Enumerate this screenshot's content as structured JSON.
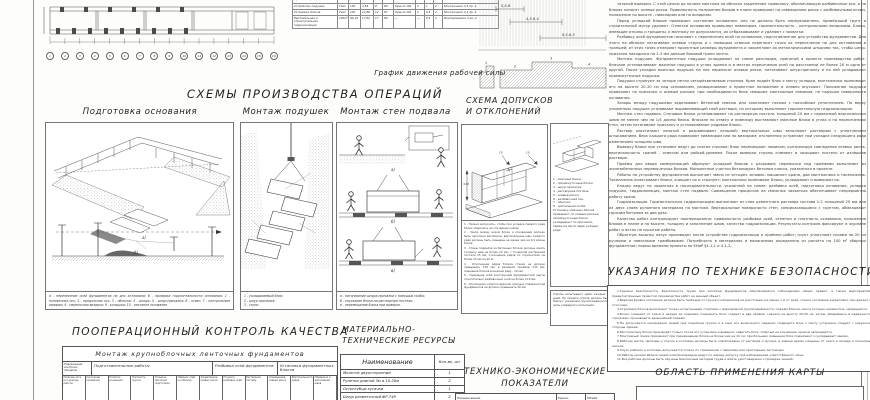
{
  "labor_chart": {
    "caption": "График движения рабочей силы"
  },
  "plan": {
    "axes": [
      "1",
      "2",
      "3",
      "4",
      "5",
      "6",
      "7",
      "8",
      "9",
      "10",
      "11",
      "12",
      "13",
      "14",
      "15",
      "16"
    ]
  },
  "labor_schedule": {
    "rows": [
      [
        "Подготовка основания (срезка недобора)",
        "100м²",
        "3,2",
        "1,8",
        "2",
        "92",
        "—",
        "—",
        "1",
        "2",
        "Землекопы 2р.-2"
      ],
      [
        "Устройство подушек",
        "Узел",
        "100",
        "4,58",
        "8",
        "90",
        "Кран К-161",
        "2",
        "1",
        "2",
        "Монтажники 4,3,2р.-3"
      ],
      [
        "Установка блоков",
        "Узел",
        "140",
        "12,89",
        "12",
        "87",
        "Кран К-161",
        "2",
        "0,5",
        "2",
        "Монтажники 4,3,2р.-3"
      ],
      [
        "Вертикальная и горизонтальная гидроизоляция",
        "100м²",
        "60,16",
        "17,62",
        "17",
        "80",
        "—",
        "—",
        "0,5",
        "2",
        "Изолировщики 3,2р.-2"
      ]
    ]
  },
  "zahvatki": {
    "dims": [
      "5,5-6",
      "4,5-6,4",
      "8,5-6,5"
    ],
    "marks": [
      "1",
      "2",
      "3",
      "4"
    ]
  },
  "operations": {
    "title": "СХЕМЫ ПРОИЗВОДСТВА ОПЕРАЦИЙ",
    "panel1": {
      "title": "Подготовка основания",
      "scene_a": "а)",
      "scene_b": "б)",
      "caption": "а - перенесение осей фундаментов на дно котлована; б - проверка горизонтальности основания; 1 - поперечная ось; 2 - продольная ось; 3 - обноска; 4 - штырь; 5 - шнур-причалка; 6 - отвес; 7 - контрольные визирки; 8 - переносная визирка; 9 - колышки; 10 - песчаное основание"
    },
    "panel2": {
      "title": "Монтаж подушек",
      "caption": "1 - укладываемый блок;\n2 - шнур-причалка;\n3 - строп."
    },
    "panel3": {
      "title": "Монтаж стен подвала",
      "scene_a": "а)",
      "scene_b": "б)",
      "scene_c": "в)",
      "caption": "а - натягивание шнура-причалки с помощью скобы;\nб - опускание блока на растворную постель;\nв - перемещение блока при выверке."
    }
  },
  "tolerances": {
    "title1": "СХЕМА ДОПУСКОВ",
    "title2": "И ОТКЛОНЕНИЙ",
    "dims": [
      "±10",
      "15",
      "10"
    ],
    "notes": [
      "1 - Нельзя допускать, чтобы при укладке первого ряда блоки опирались на случайные камни;",
      "2 - Зазор между низом блока и основанием должен быть заполнен раствором; вертикальные швы каждого ряда должны быть смещены не менее чем на 1/4 длины блока;",
      "3 - Стены подвалов из бетонных блоков должны иметь толщину шва не более 20 мм, с толщиной растворной постели 15 мм; отклонение рядов по горизонтали не более 15 мм на 10 м;",
      "4 - Отклонение рядов блоков стенки не должно превышать ±10 мм; в размерах проёмов ±15 мм; смещение блоков в нижнем ряду - 10 мм;",
      "5 - Смещение осей конструкций фундаментной ленты относительно разбивочных осей не более ±10 мм;",
      "6 - Отклонение отметок верхних опорных поверхностей фундаментов не должно превышать 20 мм"
    ],
    "legend": [
      "1 - маячные блоки;",
      "2 - промежуточные блоки;",
      "3 - шнур-причалка;",
      "4 - растворная постель;",
      "5 - осевые риски;",
      "6 - разбивочная ось;",
      "7 - обноска;",
      "8 - причальная скоба.",
      "Установку маячных блоков проверяют по осевым рискам; промежуточные блоки укладывают по причалке, перенося её по мере укладки ряда."
    ],
    "note_box": "Стропы испытывают через каждые 10 дней. На каждом стропе должна быть бирка с указанием грузоподъёмности и даты очередного испытания."
  },
  "main_text": {
    "paragraphs": [
      "тальной выверки. С этой целью до начала монтажа на обноске закрепляют проволоку, обозначающую разбивочные оси, а на блоках наносят осевые риски. Правильность положения блоков в плане проверяют по совмещению рисок с разбивочными осями, положение по высоте - нивелиром или по визиркам.",
      "Перед укладкой блоков проверяют состояние основания: оно не должно быть переувлажнено, промёрзший грунт и строительный мусор удаляют. Отметки основания проверяют нивелиром, горизонтальность - контрольными визирками. Блоки, имеющие отколы и трещины, к монтажу не допускаются, их отбраковывают и удаляют с захватки.",
      "Разбивку осей фундаментов начинают с перенесения осей на основание, подготовленное для устройства фундаментов. Для этого на обноске натягивают осевые струны и с помощью отвесов переносят точки их пересечения на дно котлованов и траншей; от этих точек отмеряют проектные размеры фундамента и закрепляют их металлическими штырями так, чтобы шнур-причалка находился на 2-3 мм дальше боковой грани ленты.",
      "Монтаж подушек. Фундаментные подушки укладывают по схеме раскладки, принятой в проекте производства работ. Вначале устанавливают маячные подушки в углах здания и в местах пересечения осей на расстоянии не более 20 м одна от другой. После укладки маячных подушек на них переносят осевые риски, натягивают шнур-причалку и по ней укладывают промежуточные подушки.",
      "Подушки стропуют за четыре петли четырёхветвевым стропом. Кран подаёт блок к месту укладки, монтажники принимают его на высоте 20-30 см над основанием, разворачивают в проектное положение и плавно опускают. Положение подушки проверяют по причалке и осевым рискам; при необходимости блок смещают монтажным ломиком, не нарушая поверхности основания.",
      "Зазоры между подушками заделывают бетонной смесью или заполняют песком с послойным уплотнением. По верху уложенных подушек устраивают выравнивающий слой раствора, по которому выполняют горизонтальную гидроизоляцию.",
      "Монтаж стен подвала. Стеновые блоки устанавливают на растворную постель толщиной 20 мм с перевязкой вертикальных швов не менее чем на 1/4 длины блока. Вначале по отвесу и нивелиру выставляют маячные блоки в углах и на пересечениях стен, затем натягивают причалку и устанавливают рядовые блоки.",
      "Раствор расстилают лопатой и разравнивают кельмой; вертикальные швы заполняют раствором с уплотнением штыкованием. Верх каждого ряда проверяют нивелиром или по визиркам; отклонения устраняют при укладке следующего ряда изменением толщины шва.",
      "Выверку блока при установке ведут до снятия стропов: блок перемещают ломиком, контролируя совпадение осевых рисок, вертикальность граней - отвесом или рейкой-уровнем. После выверки стропы снимают и зачищают постель от излишков раствора.",
      "Проёмы для ввода коммуникаций образуют укладкой блоков с разрывом; перемычки над проёмами выполняют из железобетонных перемычечных блоков. Монолитные участки бетонируют бетоном класса, указанного в проекте.",
      "Работы по устройству фундаментов выполняет звено из четырёх человек: машинист крана, два монтажника и такелажник. Такелажник осматривает блоки, очищает их и стропует; монтажники принимают блоки, укладывают и выверяют их.",
      "Кладку ведут на захватках в последовательности, указанной на схеме: разбивка осей, подготовка основания, укладка подушек, гидроизоляция, монтаж стен подвала. Совмещение процессов на смежных захватках обеспечивает непрерывную работу крана.",
      "Гидроизоляция. Горизонтальную гидроизоляцию выполняют из слоя цементного раствора состава 1:2 толщиной 20 мм или из двух слоёв рулонного материала на мастике. Вертикальные поверхности стен, соприкасающиеся с грунтом, обмазывают горячим битумом за два раза.",
      "Качество работ контролируют пооперационно: правильность разбивки осей, отметки и плотность основания, положение блоков в плане и по высоте, толщину и заполнение швов, качество гидроизоляции. Результаты контроля фиксируют в журнале работ и актах на скрытые работы.",
      "Обратную засыпку пазух производят после устройства гидроизоляции и приёмки работ; грунт уплотняют слоями по 20 см ручными и навесными трамбовками. Потребность в материалах и механизмах определена из расчёта на 100 м³ сборных фундаментов; нормы времени приняты по ЕНиР §4-1-1 и 4-1-2."
    ]
  },
  "safety": {
    "title": "УКАЗАНИЯ ПО ТЕХНИКЕ БЕЗОПАСНОСТИ",
    "lines": [
      "1.Техника безопасности. Безопасность труда при монтаже фундаментов обеспечивается соблюдением общих правил, а также мероприятий, предусмотренных проектом производства работ на данный объект.",
      "2.Верхняя бровка котлована должна быть свободна от грузов и материалов на расстоянии не менее 1 м от края; стенки котлована закрепляют или делают с откосами.",
      "3.Строповку блоков выполняют только испытанными стропами с маркировкой грузоподъёмности; подъём блоков, масса которых неизвестна, запрещается.",
      "4.Блоки очищают от грязи и наледи до подъёма; поднимать блок следует в два приёма: сначала на высоту 20-30 см, затем, убедившись в надёжности строповки, производить дальнейший подъём.",
      "5.Не допускается нахождение людей под поднятым грузом и в зоне его возможного падения; подводить блок к месту установки следует с наружной стороны здания.",
      "6.Расстроповку блока производят только после его установки и выверки; сдвигать блок, опёртый на основание, краном запрещается.",
      "7.Монтажный ломик применяют при перемещении блока не более чем на 10 см; при большем смещении блок поднимают и укладывают заново.",
      "8.Рабочие места, проходы и спуски в котлован должны быть освобождены от раствора и мусора, в зимнее время очищены от снега и наледи и посыпаны песком.",
      "9.Спуск рабочих в котлован допускается только по стремянкам с перилами или приставным лестницам.",
      "10.Работы краном вблизи линий электропередачи ведут по наряду-допуску под наблюдением ответственного лица.",
      "11.Все рабочие должны быть обучены безопасным методам труда и иметь удостоверения о проверке знаний."
    ]
  },
  "quality": {
    "title": "ПООПЕРАЦИОННЫЙ КОНТРОЛЬ КАЧЕСТВА",
    "table_title": "Монтаж крупноблочных ленточных фундаментов",
    "left_col": "Подлежащие контролю процессы",
    "groups": [
      "Подготовительные работы",
      "Разбивка осей фундаментов",
      "Установка фундаментных блоков"
    ],
    "subcols": [
      "Наличие акта на скрытые работы",
      "Состояние основания",
      "Отметки основания",
      "Плотность грунта",
      "Толщина песчаной подготовки",
      "Перенос осей на обноску",
      "Закрепление осевых рисок",
      "Точность разбивки осей",
      "Растворная постель",
      "Совмещение осевых рисок",
      "Вертикальность рядов",
      "Перевязка и заполнение швов"
    ]
  },
  "resources": {
    "title": "МАТЕРИАЛЬНО-ТЕХНИЧЕСКИЕ РЕСУРСЫ",
    "col_name": "Наименование",
    "col_qty": "Кол-во, шт",
    "rows": [
      [
        "Молоток двухсторонний",
        "1"
      ],
      [
        "Рулетки длиной 3м и 10-20м",
        "2"
      ],
      [
        "Острогубцы кусачки",
        "1"
      ],
      [
        "Шнур разметочный ФР-749",
        "2"
      ]
    ]
  },
  "tech_econ": {
    "title": "ТЕХНИКО-ЭКОНОМИЧЕСКИЕ ПОКАЗАТЕЛИ",
    "partial_cols": [
      "Наименование",
      "Едини-",
      "Объём"
    ]
  },
  "application": {
    "title": "ОБЛАСТЬ ПРИМЕНЕНИЯ КАРТЫ"
  }
}
